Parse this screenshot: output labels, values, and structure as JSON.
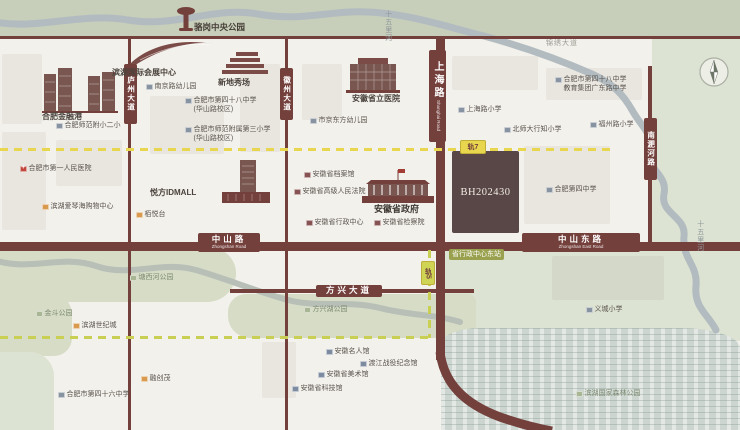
{
  "map": {
    "parcel_code": "BH202430",
    "metro": {
      "line7_badge": "轨7",
      "line5_badge": "轨5",
      "station_label": "省行政中心东站"
    },
    "colors": {
      "road": "#74403c",
      "metro_line7": "#e8d64e",
      "metro_line5": "#c9cf52",
      "parcel": "#584746",
      "park_green": "#d6dcc6",
      "water": "#b2bcc0",
      "accent_orange": "#d99a4f"
    },
    "road_badges": [
      {
        "id": "luzhou-avenue-badge",
        "x": 124,
        "y": 64,
        "w": 13,
        "h": 60,
        "label": "庐州大道",
        "vertical": true
      },
      {
        "id": "huizhou-avenue-badge",
        "x": 280,
        "y": 68,
        "w": 13,
        "h": 52,
        "label": "徽州大道",
        "vertical": true
      },
      {
        "id": "shanghai-road-badge",
        "x": 429,
        "y": 50,
        "w": 17,
        "h": 92,
        "label": "上海路",
        "sub": "Shanghai Road",
        "vertical": true,
        "big": true
      },
      {
        "id": "nanfeihe-road-badge",
        "x": 644,
        "y": 118,
        "w": 13,
        "h": 62,
        "label": "南淝河路",
        "vertical": true
      },
      {
        "id": "zhongshan-road-badge",
        "x": 198,
        "y": 233,
        "w": 62,
        "h": 19,
        "label": "中山路",
        "sub": "Zhongshan Road"
      },
      {
        "id": "zhongshan-east-road-badge",
        "x": 522,
        "y": 233,
        "w": 118,
        "h": 19,
        "label": "中山东路",
        "sub": "Zhongshan East Road"
      },
      {
        "id": "fangxing-avenue-badge",
        "x": 316,
        "y": 285,
        "w": 66,
        "h": 12,
        "label": "方兴大道"
      }
    ],
    "pois": [
      {
        "id": "luogang-central-park-label",
        "x": 194,
        "y": 22,
        "label": "骆岗中央公园",
        "type": "park-title"
      },
      {
        "id": "binhu-convention-center-label",
        "x": 112,
        "y": 68,
        "label": "滨湖国际会展中心",
        "type": "title"
      },
      {
        "id": "xindi-showplace-label",
        "x": 218,
        "y": 78,
        "label": "新地秀场",
        "type": "title"
      },
      {
        "id": "hefei-financial-port-label",
        "x": 42,
        "y": 112,
        "label": "合肥金融港",
        "type": "title"
      },
      {
        "id": "yuefang-idmall-label",
        "x": 150,
        "y": 188,
        "label": "悦方IDMALL",
        "type": "title"
      },
      {
        "id": "anhui-provincial-hospital-label",
        "x": 352,
        "y": 94,
        "label": "安徽省立医院",
        "type": "title"
      },
      {
        "id": "anhui-provincial-government-label",
        "x": 374,
        "y": 204,
        "label": "安徽省政府",
        "type": "gov-title"
      },
      {
        "id": "hefei-normal-attached-primary-2-label",
        "x": 56,
        "y": 122,
        "label": "合肥师范附小二小",
        "type": "school"
      },
      {
        "id": "nanjing-road-kindergarten-label",
        "x": 146,
        "y": 83,
        "label": "南京路幼儿园",
        "type": "school"
      },
      {
        "id": "hefei-no48-middle-huashan-label",
        "x": 185,
        "y": 97,
        "lines": [
          "合肥市第四十八中学",
          "(华山路校区)"
        ],
        "type": "school"
      },
      {
        "id": "hefei-normal-attached-primary-3-label",
        "x": 185,
        "y": 126,
        "lines": [
          "合肥市师范附属第三小学",
          "(华山路校区)"
        ],
        "type": "school"
      },
      {
        "id": "jingdongfang-kindergarten-label",
        "x": 310,
        "y": 117,
        "label": "市京东方幼儿园",
        "type": "school"
      },
      {
        "id": "shanghai-road-primary-label",
        "x": 458,
        "y": 106,
        "label": "上海路小学",
        "type": "school"
      },
      {
        "id": "xingzhi-primary-label",
        "x": 504,
        "y": 126,
        "label": "北师大行知小学",
        "type": "school"
      },
      {
        "id": "hefei-no48-middle-guangdong-label",
        "x": 555,
        "y": 76,
        "lines": [
          "合肥市第四十八中学",
          "教育集团广东路中学"
        ],
        "type": "school"
      },
      {
        "id": "fuzhou-road-primary-label",
        "x": 590,
        "y": 121,
        "label": "福州路小学",
        "type": "school"
      },
      {
        "id": "hefei-no4-middle-label",
        "x": 546,
        "y": 186,
        "label": "合肥第四中学",
        "type": "school"
      },
      {
        "id": "yicheng-primary-label",
        "x": 586,
        "y": 306,
        "label": "义城小学",
        "type": "school"
      },
      {
        "id": "hefei-no46-middle-label",
        "x": 58,
        "y": 391,
        "label": "合肥市第四十六中学",
        "type": "school"
      },
      {
        "id": "anhui-archives-label",
        "x": 304,
        "y": 171,
        "label": "安徽省档案馆",
        "type": "gov"
      },
      {
        "id": "anhui-high-court-label",
        "x": 294,
        "y": 188,
        "label": "安徽省高级人民法院",
        "type": "gov"
      },
      {
        "id": "anhui-admin-center-label",
        "x": 306,
        "y": 219,
        "label": "安徽省行政中心",
        "type": "gov"
      },
      {
        "id": "anhui-procuratorate-label",
        "x": 374,
        "y": 219,
        "label": "安徽省检察院",
        "type": "gov"
      },
      {
        "id": "hefei-first-peoples-hospital-label",
        "x": 20,
        "y": 165,
        "label": "合肥市第一人民医院",
        "type": "hospital"
      },
      {
        "id": "aegean-shopping-center-label",
        "x": 42,
        "y": 203,
        "label": "滨湖爱琴海购物中心",
        "type": "mall"
      },
      {
        "id": "baiyuetai-label",
        "x": 136,
        "y": 211,
        "label": "栢悦台",
        "type": "mall"
      },
      {
        "id": "binhu-century-town-label",
        "x": 73,
        "y": 322,
        "label": "滨湖世纪城",
        "type": "mall"
      },
      {
        "id": "rongchuangmao-label",
        "x": 141,
        "y": 375,
        "label": "融创茂",
        "type": "mall"
      },
      {
        "id": "anhui-celebrity-museum-label",
        "x": 326,
        "y": 348,
        "label": "安徽名人馆",
        "type": "museum"
      },
      {
        "id": "dujiang-campaign-memorial-label",
        "x": 360,
        "y": 360,
        "label": "渡江战役纪念馆",
        "type": "museum"
      },
      {
        "id": "anhui-art-museum-label",
        "x": 318,
        "y": 371,
        "label": "安徽省美术馆",
        "type": "museum"
      },
      {
        "id": "anhui-science-museum-label",
        "x": 292,
        "y": 385,
        "label": "安徽省科技馆",
        "type": "museum"
      },
      {
        "id": "tangxihe-park-label",
        "x": 130,
        "y": 274,
        "label": "塘西河公园",
        "type": "park"
      },
      {
        "id": "jindou-park-label",
        "x": 36,
        "y": 310,
        "label": "金斗公园",
        "type": "park"
      },
      {
        "id": "fangxinghu-park-label",
        "x": 304,
        "y": 306,
        "label": "方兴湖公园",
        "type": "park"
      },
      {
        "id": "binhu-forest-park-label",
        "x": 576,
        "y": 390,
        "label": "滨湖国家森林公园",
        "type": "park"
      },
      {
        "id": "shiwuli-river-label-top",
        "x": 383,
        "y": 10,
        "label": "十五里河",
        "type": "river"
      },
      {
        "id": "shiwuli-river-label-east",
        "x": 695,
        "y": 220,
        "label": "十五里河",
        "type": "river"
      },
      {
        "id": "jinxiu-avenue-label",
        "x": 546,
        "y": 40,
        "label": "锦绣大道",
        "type": "grayroad"
      }
    ]
  }
}
